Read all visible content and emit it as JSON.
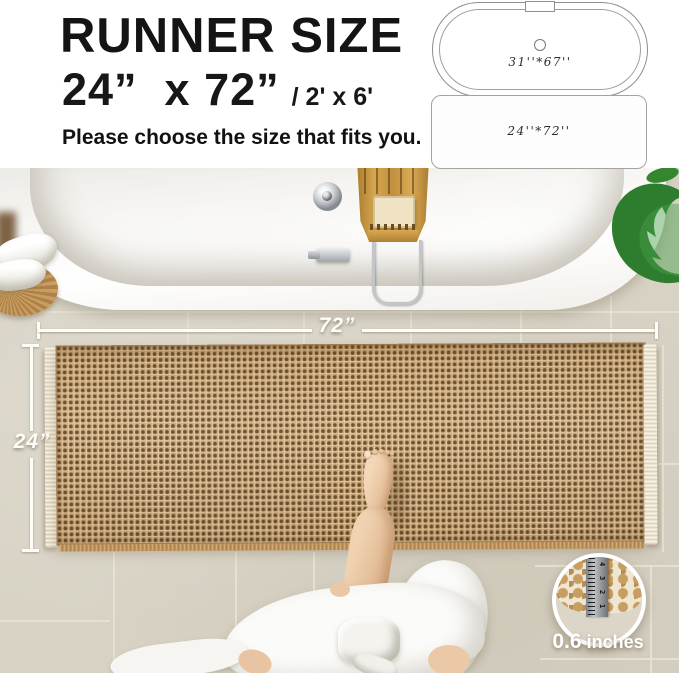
{
  "header": {
    "title": "RUNNER SIZE",
    "size_primary": "24”  x 72”",
    "size_secondary": "/ 2' x 6'",
    "subtitle": "Please choose the size that fits you.",
    "tub_option_label": "31''*67''",
    "mat_option_label": "24''*72''"
  },
  "photo": {
    "width_label": "72”",
    "height_label": "24”",
    "inset": {
      "pile_value": "0.6",
      "pile_unit": "inches",
      "ruler_numbers": [
        "4",
        "3",
        "2",
        "1"
      ]
    }
  },
  "colors": {
    "title_black": "#141414",
    "floor_tile": "#d8d3c5",
    "rug_tan": "#c9a271",
    "leaf_green": "#2e7d2e",
    "annotation_white": "#ffffff"
  }
}
